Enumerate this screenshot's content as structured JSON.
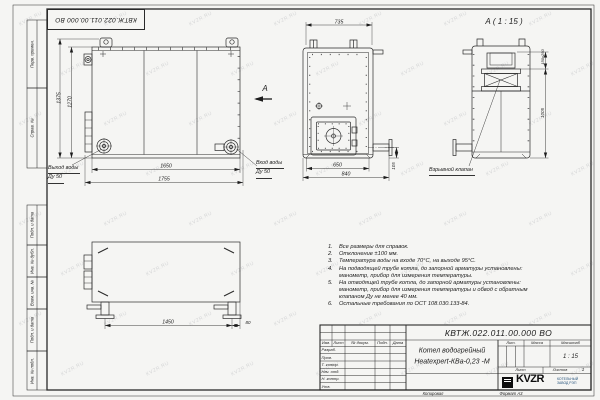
{
  "sheet": {
    "code_inverted": "КВТЖ.022.011.00.000 ВО",
    "watermark": "KVZR.RU",
    "below_frame": {
      "copied_label": "Копировал",
      "format_label": "Формат А3"
    }
  },
  "margin_labels": [
    "Перв. примен.",
    "Справ. №",
    "Подп. и дата",
    "Инв. № дубл.",
    "Взам. инв. №",
    "Подп. и дата",
    "Инв. № подл."
  ],
  "views": {
    "front": {
      "dims": {
        "height_overall": "1375",
        "height_body": "1270",
        "width_ports": "1650",
        "width_overall": "1755"
      },
      "outlet_line1": "Выход воды",
      "outlet_line2": "Ду 50",
      "inlet_line1": "Вход воды",
      "inlet_line2": "Ду 50",
      "view_arrow_label": "А"
    },
    "side": {
      "dims": {
        "width_top": "735",
        "width_door": "650",
        "width_overall": "840",
        "stub_height": "105"
      }
    },
    "detail": {
      "title": "А ( 1 : 15 )",
      "dims": {
        "valve_size": "150x250",
        "height": "1005"
      },
      "valve_label": "Взрывной клапан"
    },
    "bottom": {
      "dims": {
        "leg_span": "1450",
        "offset": "80"
      }
    }
  },
  "notes": [
    {
      "num": "1.",
      "lines": [
        "Все размеры для справок."
      ]
    },
    {
      "num": "2.",
      "lines": [
        "Отклонение ±100 мм."
      ]
    },
    {
      "num": "3.",
      "lines": [
        "Температура воды на входе 70°С, на выходе 95°С."
      ]
    },
    {
      "num": "4.",
      "lines": [
        "На подводящей трубе котла, до запорной арматуры установлены:",
        "манометр, прибор для измерения температуры."
      ]
    },
    {
      "num": "5.",
      "lines": [
        "На отводящей трубе котла, до запорной арматуры установлены:",
        "манометр, прибор для измерения температуры и обвод с обратным",
        "клапаном Ду не менее 40 мм."
      ]
    },
    {
      "num": "6.",
      "lines": [
        "Остальные требования по ОСТ 108.030.133-84."
      ]
    }
  ],
  "title_block": {
    "designation": "КВТЖ.022.011.00.000 ВО",
    "product_name_line1": "Котел водогрейный",
    "product_name_line2": "Heatexpert-КВа-0,23 -М",
    "header_cols": {
      "izm": "Изм.",
      "list": "Лист",
      "doc": "№ докум.",
      "podp": "Подп.",
      "data": "Дата"
    },
    "sig_rows": [
      "Разраб.",
      "Пров.",
      "Т. контр.",
      "Нач. отд.",
      "Н. контр.",
      "Утв."
    ],
    "lit_label": "Лит.",
    "mass_label": "Масса",
    "scale_label": "Масштаб",
    "scale_value": "1 : 15",
    "sheet_label": "Лист",
    "sheets_label": "Листов",
    "sheets_value": "1",
    "logo_text": "KVZR",
    "company_line1": "КОТЕЛЬНЫЙ",
    "company_line2": "ЗАВОД РЭП"
  }
}
